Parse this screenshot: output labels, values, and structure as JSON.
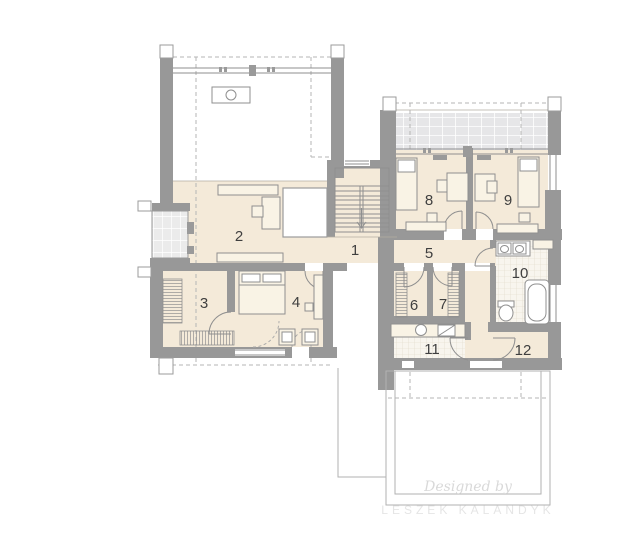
{
  "plan": {
    "rooms": [
      {
        "number": "1"
      },
      {
        "number": "2"
      },
      {
        "number": "3"
      },
      {
        "number": "4"
      },
      {
        "number": "5"
      },
      {
        "number": "6"
      },
      {
        "number": "7"
      },
      {
        "number": "8"
      },
      {
        "number": "9"
      },
      {
        "number": "10"
      },
      {
        "number": "11"
      },
      {
        "number": "12"
      }
    ],
    "watermark": {
      "line1": "Designed by",
      "line2": "LESZEK KALANDYK"
    },
    "colors": {
      "background": "#ffffff",
      "floor": "#f4ead9",
      "wall": "#989898",
      "line": "#8f8f8f",
      "terrace_tile": "#e6e6e8",
      "bath_tile": "#f8f5ee",
      "dash": "#b5b5b5",
      "label_text": "#3f3f3f",
      "watermark": "#d9d9d9"
    }
  }
}
